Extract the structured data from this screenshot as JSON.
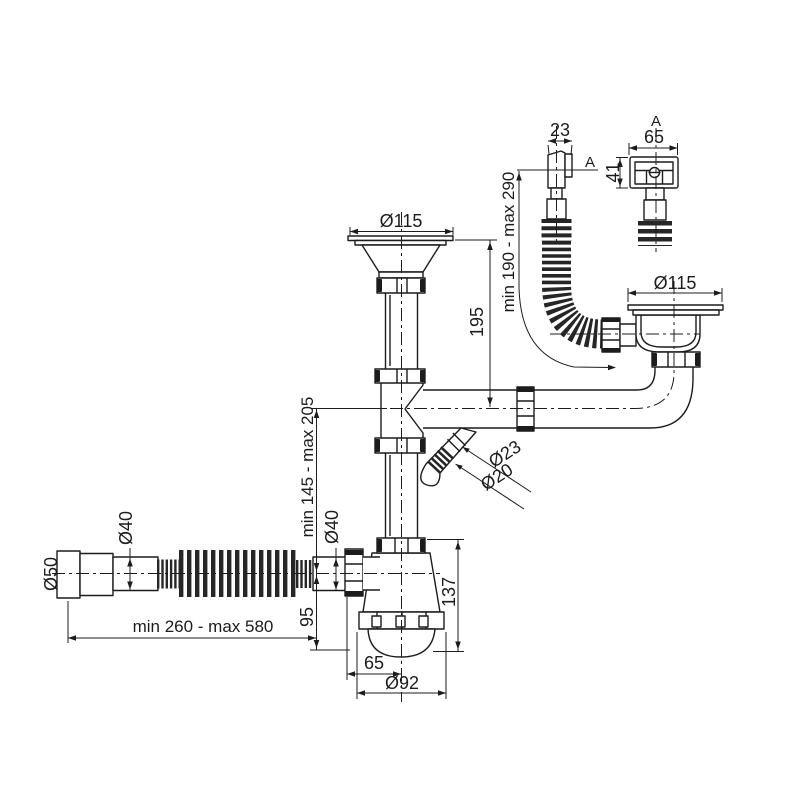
{
  "drawing": {
    "type": "technical-drawing",
    "colors": {
      "line": "#1c1c1c",
      "background": "#ffffff"
    },
    "labels": {
      "top_drain_dia": "Ø115",
      "right_drain_dia": "Ø115",
      "drain_height": "195",
      "overflow_hose_range": "min 190 - max 290",
      "overflow_neck_width": "23",
      "section_marker": "A",
      "detail_marker": "A",
      "overflow_cover_width": "65",
      "overflow_cover_height": "41",
      "spout_outer_dia": "Ø23",
      "spout_inner_dia": "Ø20",
      "inlet_height_range": "min 145 - max 205",
      "hose_dia_left": "Ø40",
      "hose_dia_right": "Ø40",
      "hose_end_dia": "Ø50",
      "hose_length_range": "min 260 - max 580",
      "outlet_drop": "95",
      "siphon_height": "137",
      "siphon_offset": "65",
      "siphon_cup_dia": "Ø92"
    }
  }
}
